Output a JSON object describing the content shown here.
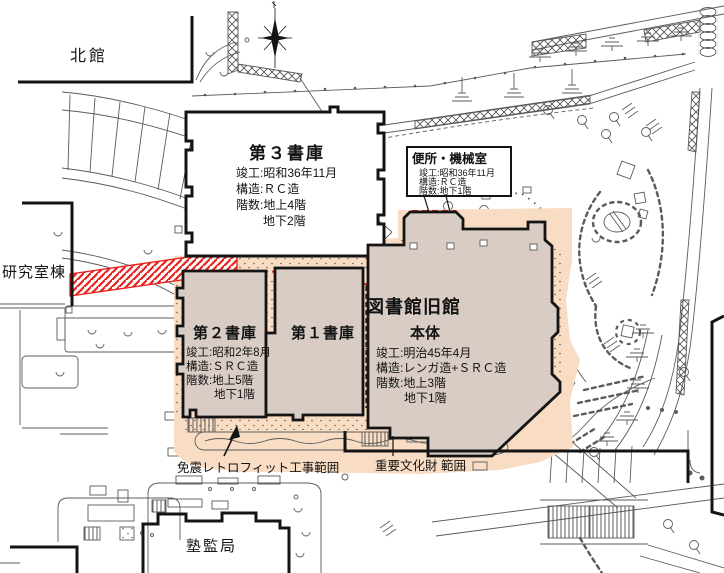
{
  "colors": {
    "building_fill": "#d8ccc4",
    "retrofit_zone": "#f8dcc3",
    "highlight_red": "#e8211c",
    "thin_line": "#5b5b5b",
    "wall": "#141414"
  },
  "labels": {
    "north_building": "北館",
    "research_building": "研究室棟",
    "juku_admin_office": "塾監局",
    "retrofit_work_range": "免震レトロフィット工事範囲",
    "cultural_property_range": "重要文化財 範囲"
  },
  "buildings": {
    "stack3": {
      "name": "第３書庫",
      "details": [
        "竣工:昭和36年11月",
        "構造:ＲＣ造",
        "階数:地上4階",
        "地下2階"
      ]
    },
    "stack2": {
      "name": "第２書庫",
      "details": [
        "竣工:昭和2年8月",
        "構造:ＳＲＣ造",
        "階数:地上5階",
        "地下1階"
      ]
    },
    "stack1": {
      "name": "第１書庫"
    },
    "old_library": {
      "name": "図書館旧館",
      "subtitle": "本体",
      "details": [
        "竣工:明治45年4月",
        "構造:レンガ造+ＳＲＣ造",
        "階数:地上3階",
        "地下1階"
      ]
    },
    "toilet_machine_room": {
      "name": "便所・機械室",
      "details": [
        "竣工:昭和36年11月",
        "構造:ＲＣ造",
        "階数:地下1階"
      ]
    }
  }
}
